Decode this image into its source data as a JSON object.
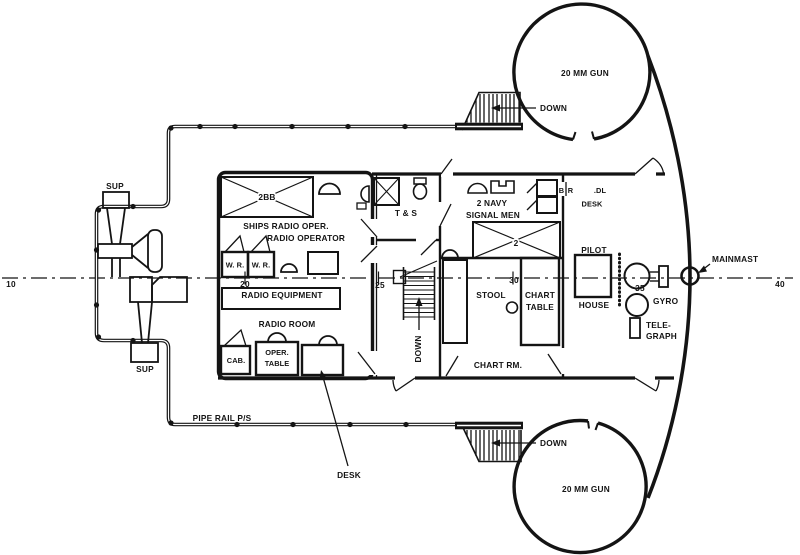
{
  "colors": {
    "ink": "#141414",
    "paper": "#ffffff"
  },
  "frames": {
    "f10": "10",
    "f20": "20",
    "f25": "25",
    "f30": "30",
    "f35": "35",
    "f40": "40"
  },
  "deck": {
    "pipe_rail": "PIPE RAIL P/S",
    "mainmast": "MAINMAST",
    "sup_top": "SUP",
    "sup_bottom": "SUP",
    "gun_top": "20 MM GUN",
    "gun_bottom": "20 MM GUN",
    "down_top": "DOWN",
    "down_bottom": "DOWN",
    "down_stairs": "DOWN",
    "desk_callout": "DESK"
  },
  "rooms": {
    "radio": {
      "name": "RADIO ROOM",
      "bunk": "2BB",
      "oper1": "SHIPS RADIO OPER.",
      "oper2": "RADIO OPERATOR",
      "wr1": "W. R.",
      "wr2": "W. R.",
      "equipment": "RADIO EQUIPMENT",
      "cab": "CAB.",
      "table1": "OPER.",
      "table2": "TABLE"
    },
    "ts": {
      "name": "T & S"
    },
    "signal": {
      "name1": "2 NAVY",
      "name2": "SIGNAL MEN",
      "bunk": "2"
    },
    "chart": {
      "name": "CHART RM.",
      "stool": "STOOL",
      "table1": "CHART",
      "table2": "TABLE"
    },
    "pilot": {
      "name1": "PILOT",
      "name2": "HOUSE",
      "br_b": "B",
      "br_r": "R",
      "br_dl": ".DL",
      "desk": "DESK",
      "gyro": "GYRO",
      "tel1": "TELE-",
      "tel2": "GRAPH"
    }
  }
}
